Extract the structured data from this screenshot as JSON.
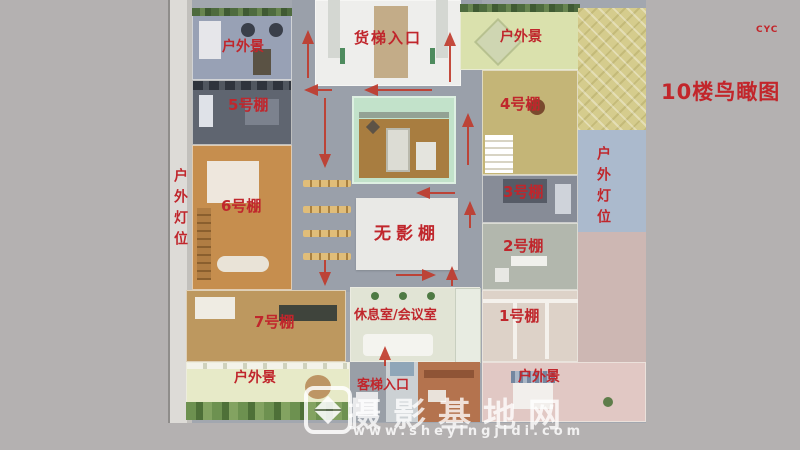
{
  "title": "10楼鸟瞰图",
  "credit": "CYC",
  "rooms": {
    "freight_elevator": "货梯入口",
    "passenger_elevator": "客梯入口",
    "shadowless_studio": "无影棚",
    "lounge_meeting": "休息室/会议室",
    "studio1": "1号棚",
    "studio2": "2号棚",
    "studio3": "3号棚",
    "studio4": "4号棚",
    "studio5": "5号棚",
    "studio6": "6号棚",
    "studio7": "7号棚",
    "outdoor_scene_top_left": "户外景",
    "outdoor_scene_top_right": "户外景",
    "outdoor_scene_bottom_left": "户外景",
    "outdoor_scene_bottom_right": "户外景",
    "outdoor_lights_left": "户外灯位",
    "outdoor_lights_right": "户外灯位"
  },
  "watermark": {
    "site_name": "摄影基地网",
    "url": "www.sheyingjidi.com"
  },
  "colors": {
    "background": "#b4b1b1",
    "label_red": "#c0262c",
    "arrow_red": "#c0392b",
    "corridor_gray": "#9aa0aa",
    "shadowless_white": "#e9e9e6"
  },
  "arrows": [
    {
      "x1": 308,
      "y1": 78,
      "x2": 308,
      "y2": 32
    },
    {
      "x1": 450,
      "y1": 82,
      "x2": 450,
      "y2": 34
    },
    {
      "x1": 432,
      "y1": 90,
      "x2": 366,
      "y2": 90
    },
    {
      "x1": 332,
      "y1": 90,
      "x2": 306,
      "y2": 90
    },
    {
      "x1": 325,
      "y1": 98,
      "x2": 325,
      "y2": 166
    },
    {
      "x1": 325,
      "y1": 260,
      "x2": 325,
      "y2": 284
    },
    {
      "x1": 455,
      "y1": 193,
      "x2": 418,
      "y2": 193
    },
    {
      "x1": 468,
      "y1": 165,
      "x2": 468,
      "y2": 115
    },
    {
      "x1": 470,
      "y1": 228,
      "x2": 470,
      "y2": 203
    },
    {
      "x1": 396,
      "y1": 275,
      "x2": 434,
      "y2": 275
    },
    {
      "x1": 452,
      "y1": 286,
      "x2": 452,
      "y2": 268
    },
    {
      "x1": 385,
      "y1": 366,
      "x2": 385,
      "y2": 348
    }
  ]
}
